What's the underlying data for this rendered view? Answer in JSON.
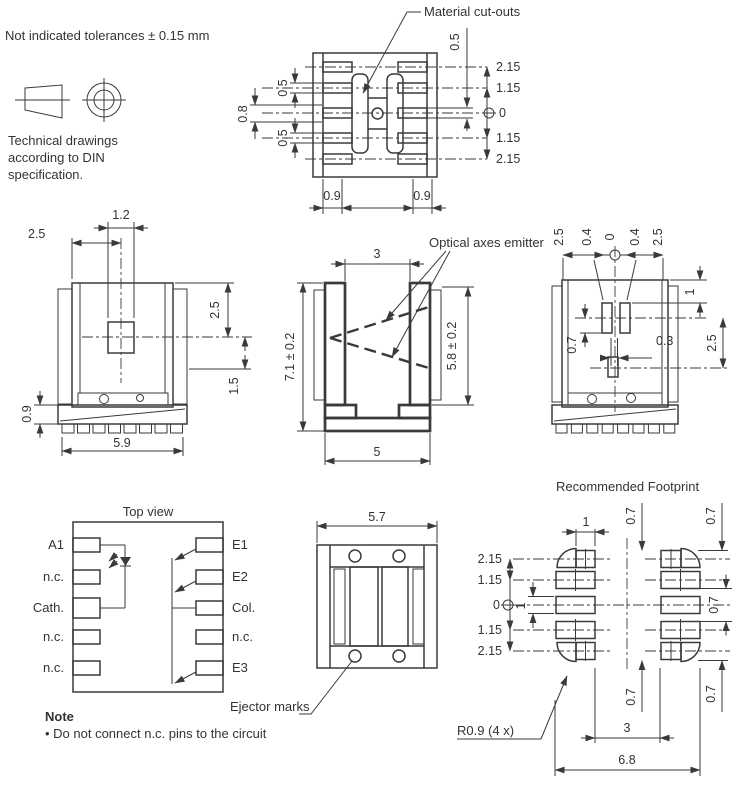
{
  "colors": {
    "line": "#3a3a3a",
    "text": "#333333",
    "background": "#ffffff"
  },
  "header": {
    "tolerance_note": "Not indicated tolerances ± 0.15 mm",
    "din_note_1": "Technical drawings",
    "din_note_2": "according to DIN",
    "din_note_3": "specification."
  },
  "bottom_view": {
    "callout": "Material cut-outs",
    "pin_width_top": "0.5",
    "pin_gap": "0.8",
    "pin_width_bottom": "0.5",
    "center_slot": "0.5",
    "rows": [
      "2.15",
      "1.15",
      "0",
      "1.15",
      "2.15"
    ],
    "pad_left": "0.9",
    "pad_right": "0.9"
  },
  "front_view": {
    "window_width": "1.2",
    "window_offset": "2.5",
    "center_from_top": "2.5",
    "mark_offset": "1.5",
    "base_height": "0.9",
    "width": "5.9"
  },
  "side_view": {
    "callout": "Optical axes emitter",
    "slot_width": "3",
    "height": "7.1 ± 0.2",
    "inner_height": "5.8 ± 0.2",
    "base_width": "5"
  },
  "rear_view": {
    "top_dims": [
      "2.5",
      "0.4",
      "0",
      "0.4",
      "2.5"
    ],
    "top_inset": "1",
    "sensor_offset": "2.5",
    "sensor_gap": "0.7",
    "slot_gap": "0.3"
  },
  "pinout": {
    "title": "Top view",
    "left_pins": [
      "A1",
      "n.c.",
      "Cath.",
      "n.c.",
      "n.c."
    ],
    "right_pins": [
      "E1",
      "E2",
      "Col.",
      "n.c.",
      "E3"
    ],
    "ejector_callout": "Ejector marks"
  },
  "package_top": {
    "width": "5.7"
  },
  "footprint": {
    "title": "Recommended Footprint",
    "pad_width": "1",
    "rows": [
      "2.15",
      "1.15",
      "0",
      "1.15",
      "2.15"
    ],
    "pad_height": "1",
    "clearance_top": "0.7",
    "clearance_top_right": "0.7",
    "clearance_mid": "0.7",
    "clearance_bottom": "0.7",
    "clearance_bottom_right": "0.7",
    "gap": "3",
    "total_width": "6.8",
    "radius_callout": "R0.9 (4 x)"
  },
  "note": {
    "title": "Note",
    "item": "• Do not connect n.c. pins to the circuit"
  }
}
